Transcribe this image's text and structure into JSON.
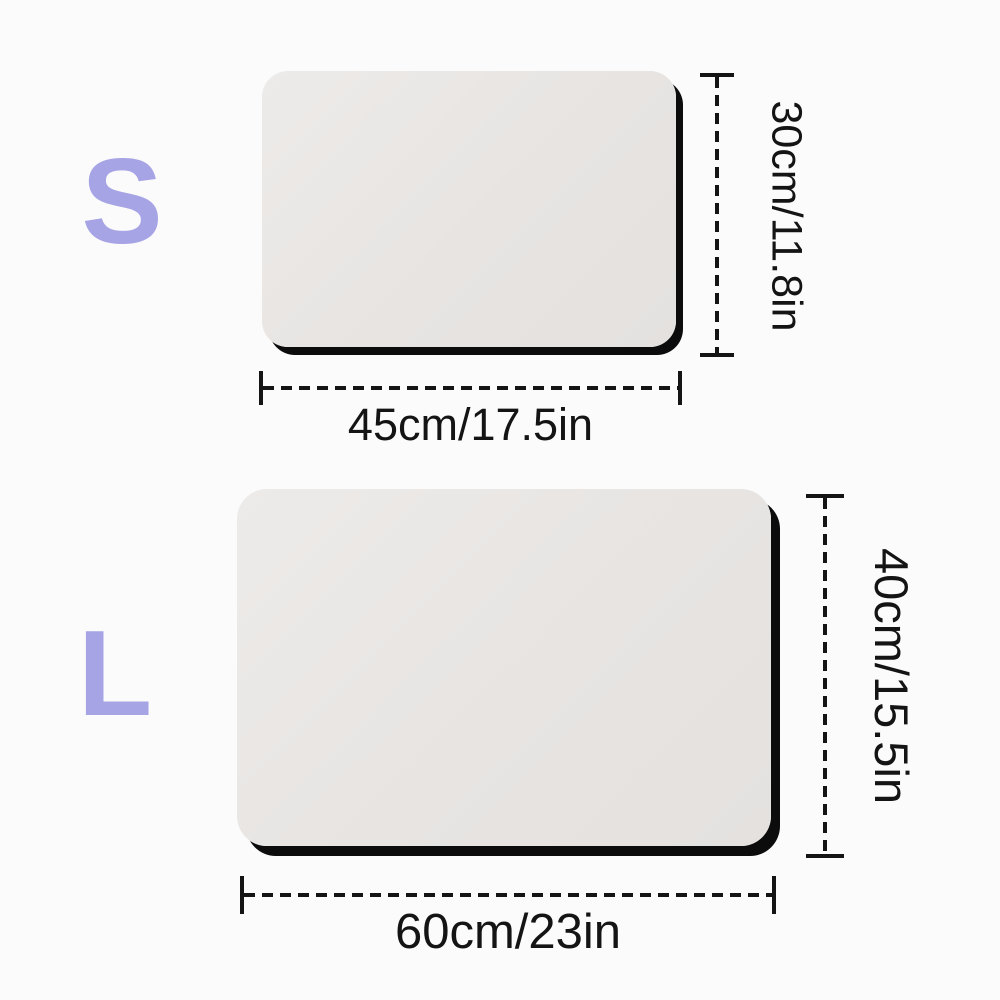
{
  "diagram": {
    "subject": "mat-size-chart",
    "colors": {
      "background": "#fcfbfb",
      "size_letter": "#a7a4e5",
      "mat_fill": "#e8e5e3",
      "mat_shadow": "#0c0c0c",
      "dimension_line": "#141414"
    },
    "sizes": [
      {
        "label": "S",
        "width_label": "45cm/17.5in",
        "height_label": "30cm/11.8in"
      },
      {
        "label": "L",
        "width_label": "60cm/23in",
        "height_label": "40cm/15.5in"
      }
    ]
  }
}
